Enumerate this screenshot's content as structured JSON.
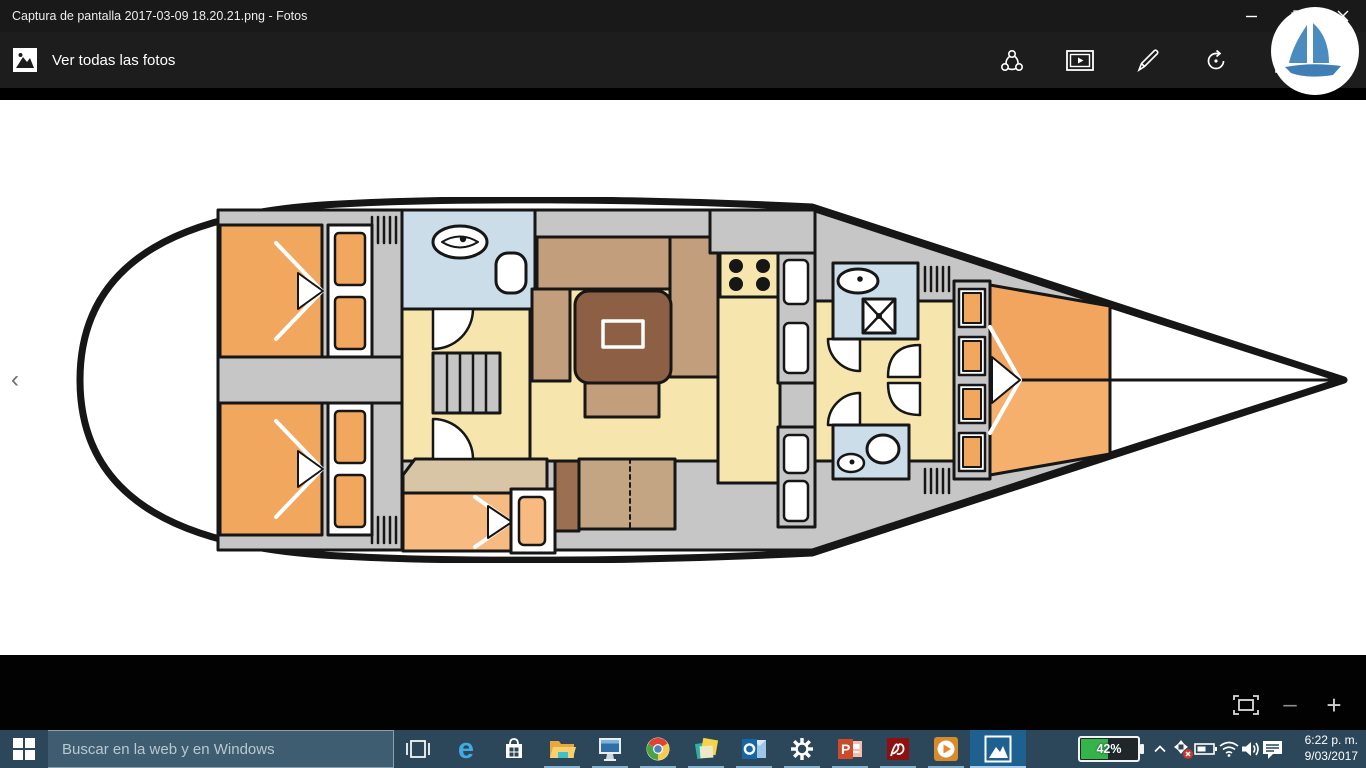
{
  "window": {
    "title": "Captura de pantalla 2017-03-09 18.20.21.png - Fotos"
  },
  "appbar": {
    "view_all_label": "Ver todas las fotos",
    "icons": [
      "share-icon",
      "slideshow-icon",
      "edit-pencil-icon",
      "rotate-icon",
      "delete-icon"
    ],
    "logo": "sailboat-logo"
  },
  "viewer": {
    "prev_arrow": "‹"
  },
  "zoom_controls": {
    "fit": "fit-to-window",
    "out": "zoom-out",
    "in_": "zoom-in",
    "minus_glyph": "–",
    "plus_glyph": "+"
  },
  "taskbar": {
    "search_placeholder": "Buscar en la web y en Windows",
    "apps": [
      "edge",
      "store",
      "file-explorer",
      "pc-monitor",
      "chrome",
      "sticky-notes",
      "outlook",
      "settings",
      "powerpoint",
      "acrobat-reader",
      "media-player",
      "photos"
    ],
    "active_app": "photos",
    "edge_glyph": "e"
  },
  "tray": {
    "battery_percent": "42%",
    "time": "6:22 p. m.",
    "date": "9/03/2017"
  },
  "floorplan": {
    "type": "sailboat-interior-plan",
    "rooms": [
      "aft-cabin-port",
      "aft-cabin-starboard",
      "aft-head",
      "companionway-stairs",
      "saloon",
      "galley",
      "lower-berth-cabin",
      "forward-head-port",
      "forward-head-starboard",
      "v-berth",
      "bow"
    ],
    "palette": {
      "outline": "#161616",
      "deck": "#c6c6c6",
      "bed_orange": "#f2a75e",
      "bed_light_orange": "#f7bb82",
      "floor_yellow": "#f6e5ac",
      "bathroom_blue": "#cbdde9",
      "sofa_tan": "#c39e7c",
      "table_brown": "#8d6045",
      "desk_tan": "#d8c5a5",
      "panel_brown": "#9b6f52"
    }
  }
}
